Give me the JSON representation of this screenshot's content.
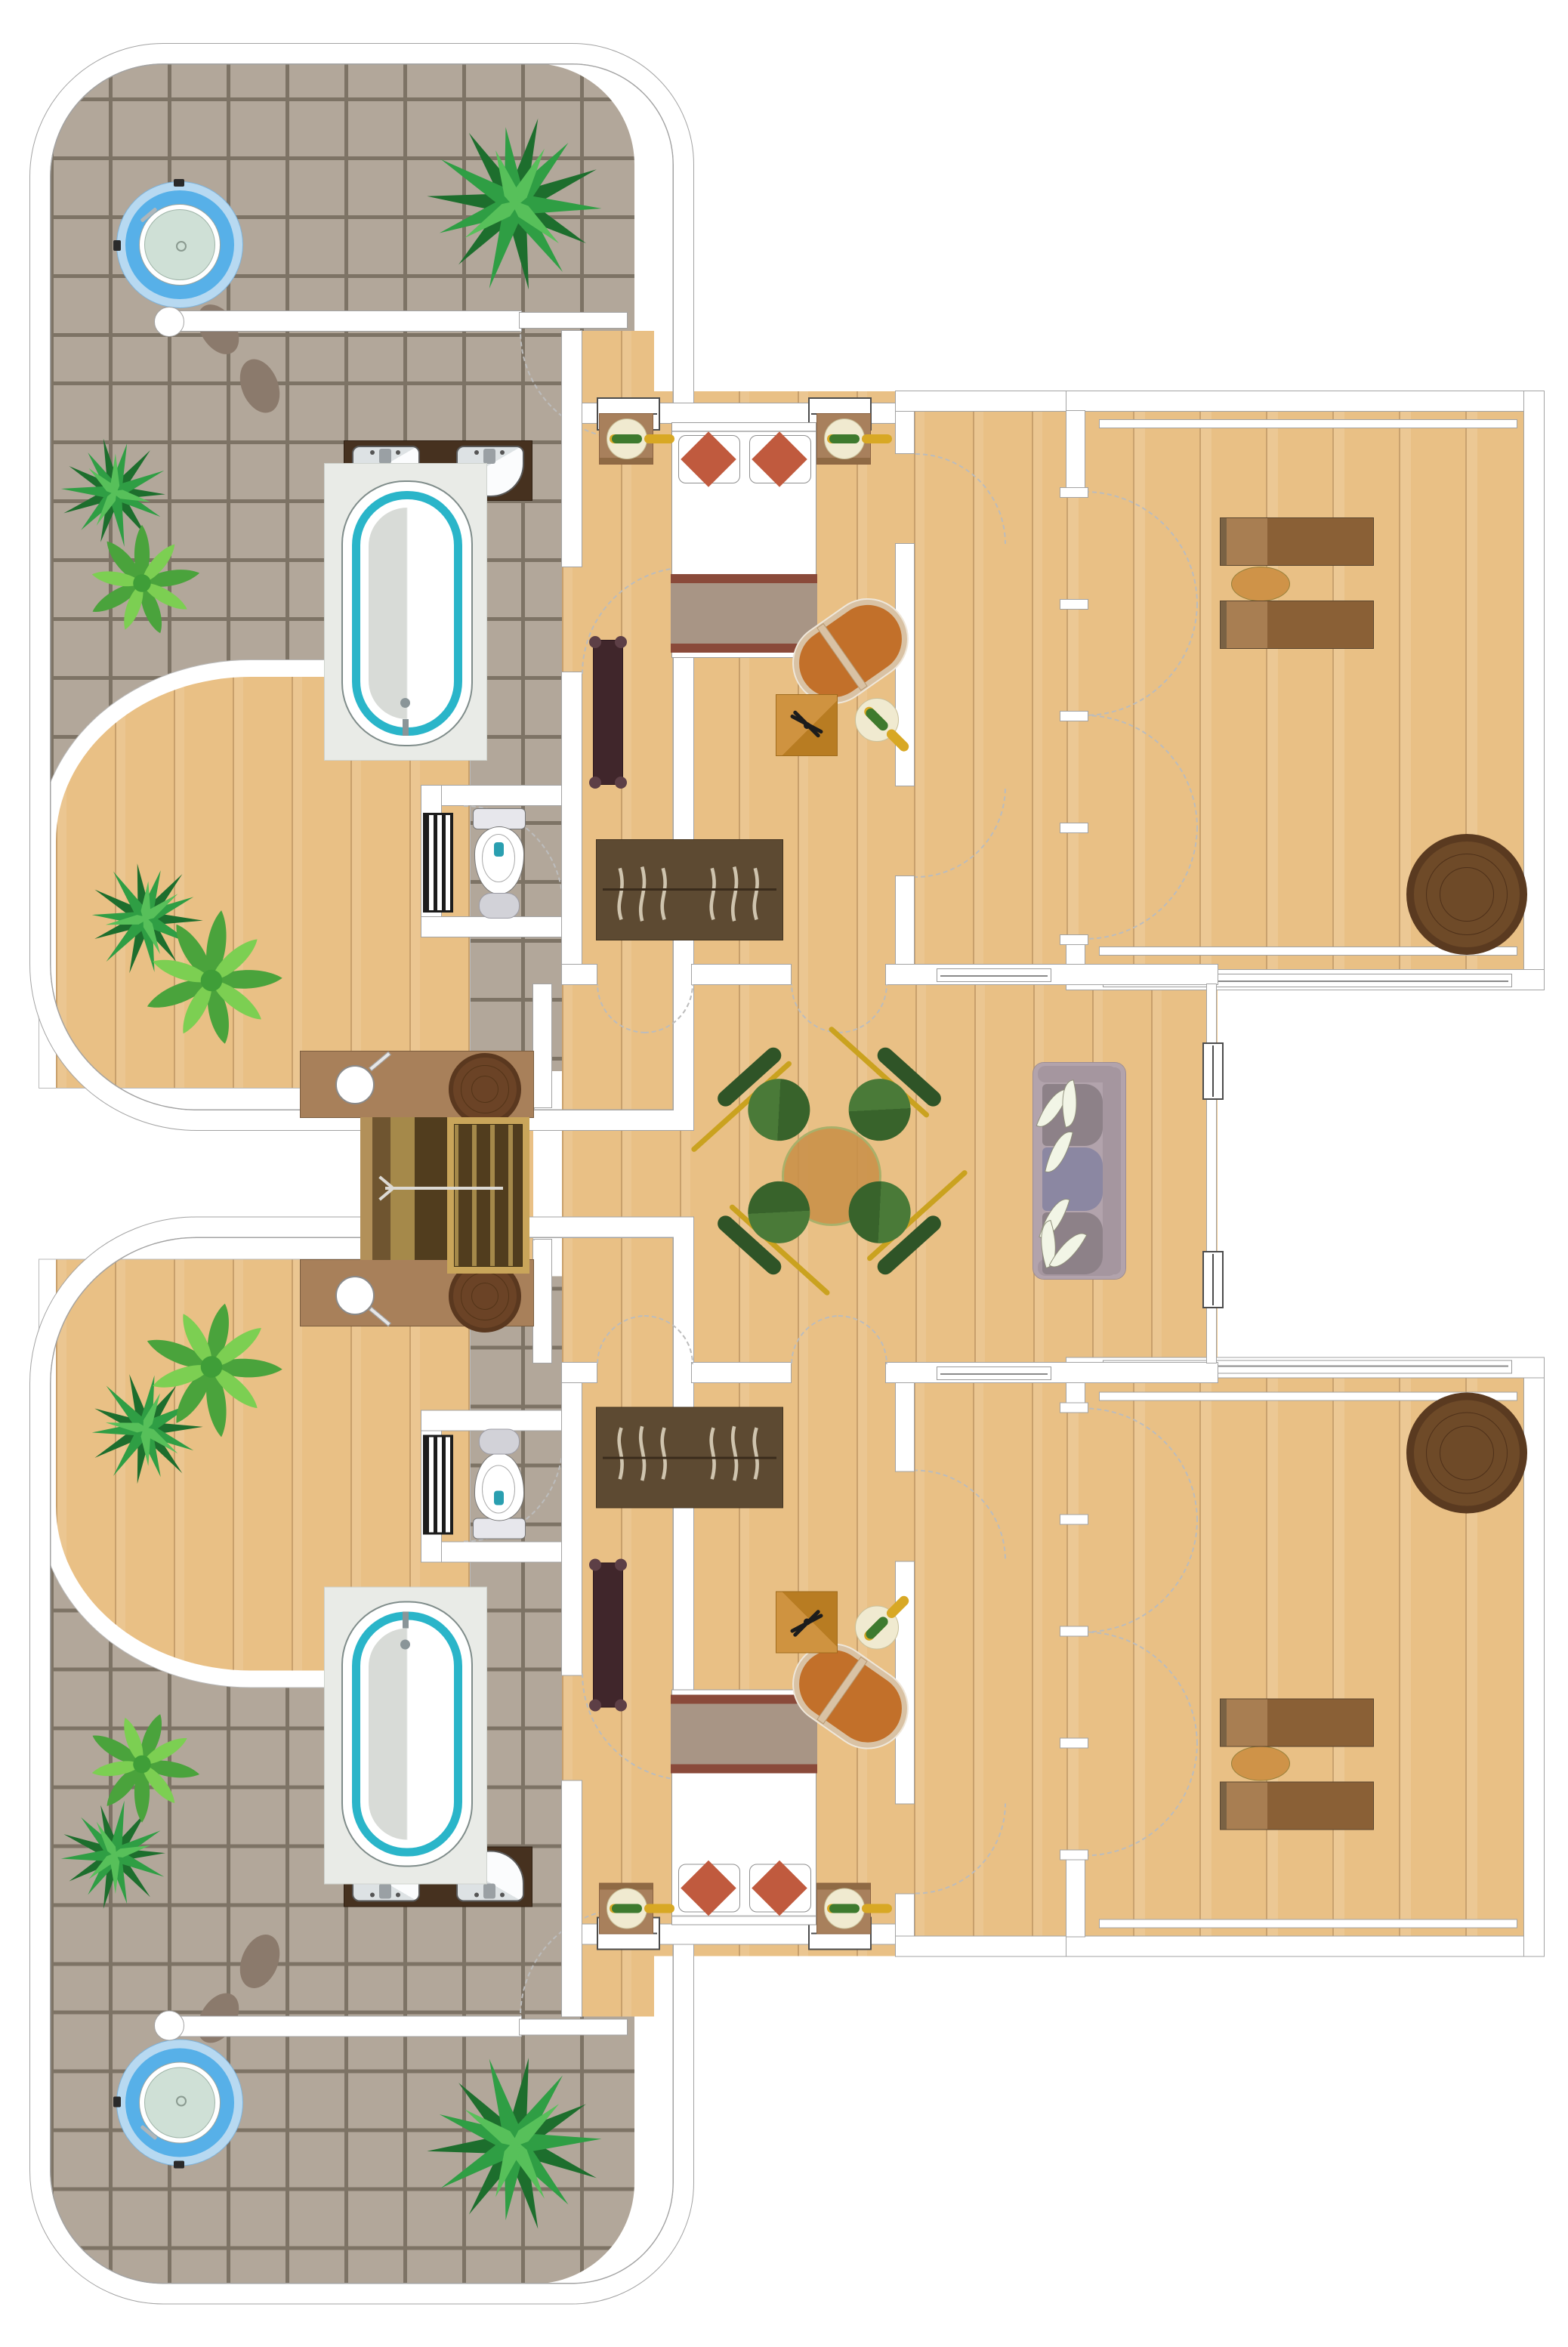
{
  "floor_plan": {
    "kind": "resort-villa-two-bedroom-suite-top-view",
    "units": [
      {
        "id": "upper-unit",
        "label": "Upper villa unit"
      },
      {
        "id": "lower-unit",
        "label": "Lower villa unit (mirrored)"
      }
    ],
    "rooms": [
      {
        "id": "bath-terrace",
        "label": "Open-air bath terrace with jacuzzi"
      },
      {
        "id": "garden",
        "label": "Private garden corner with palms"
      },
      {
        "id": "bathroom",
        "label": "Bathroom with double vanity and bathtub"
      },
      {
        "id": "wc",
        "label": "WC with toilet and radiator"
      },
      {
        "id": "bedroom",
        "label": "Bedroom with double bed"
      },
      {
        "id": "corridor",
        "label": "Corridor to sun deck"
      },
      {
        "id": "sun-deck",
        "label": "Timber sun deck with loungers"
      },
      {
        "id": "living-hall",
        "label": "Shared living and dining hall"
      },
      {
        "id": "stairs",
        "label": "Entry staircase with landings"
      }
    ],
    "fixtures": {
      "jacuzzi": {
        "count": 2,
        "water_color": "#cfe0d6",
        "ring_color": "#57b0e8"
      },
      "bathtub": {
        "count": 2,
        "rim_color": "#2ab5c9"
      },
      "vanity_sinks": {
        "count": 4,
        "counter_color": "#46311f"
      },
      "toilet": {
        "count": 2,
        "flush_button_color": "#2a9fb0"
      },
      "radiator": {
        "count": 2
      },
      "closet": {
        "count": 2,
        "color": "#5d4a32"
      },
      "bed": {
        "count": 2,
        "cushion_color": "#c05a3e",
        "blanket_colors": [
          "#8a4a3a",
          "#a89585"
        ]
      },
      "nightstand_with_lamp": {
        "count": 4,
        "lamp_colors": [
          "#f0ead0",
          "#3e7a2e"
        ]
      },
      "bench": {
        "count": 2,
        "color": "#40262b"
      },
      "chaise_lounge": {
        "count": 2,
        "color": "#c2702a"
      },
      "rug_with_fan": {
        "count": 2,
        "rug_color": "#cc8f3e"
      },
      "round_stool": {
        "count": 2
      },
      "sun_lounger": {
        "count": 4,
        "color": "#8a6036"
      },
      "deck_side_table": {
        "count": 2,
        "color": "#cf9348"
      },
      "pouf": {
        "count": 2,
        "color": "#6e4a28"
      },
      "dining_table": {
        "count": 1,
        "color": "#c89048",
        "seats": 4
      },
      "dining_chair": {
        "count": 4,
        "color": "#3e6b2f"
      },
      "sofa": {
        "count": 1,
        "color": "#b2a3ac",
        "pillows": 6
      },
      "stepping_stones": {
        "count": 4
      },
      "plants": {
        "count": 10,
        "types": [
          "fan-palm",
          "broadleaf-palm"
        ]
      }
    },
    "stairs": {
      "direction_arrow": "left",
      "flights": 2,
      "landing_color": "#a8805a"
    },
    "palette": {
      "wall": "#ffffff",
      "wall_line": "#a3a3a3",
      "tile": "#b2a79a",
      "grout": "#7d7365",
      "wood": "#e9c085",
      "plank_line": "#c2955b",
      "stair_light": "#a5894a",
      "stair_dark": "#513d1e",
      "stair_frame": "#c9a55a",
      "green_dark": "#1d6e2d",
      "green_mid": "#2f9e44",
      "green_light": "#57c05a"
    }
  }
}
